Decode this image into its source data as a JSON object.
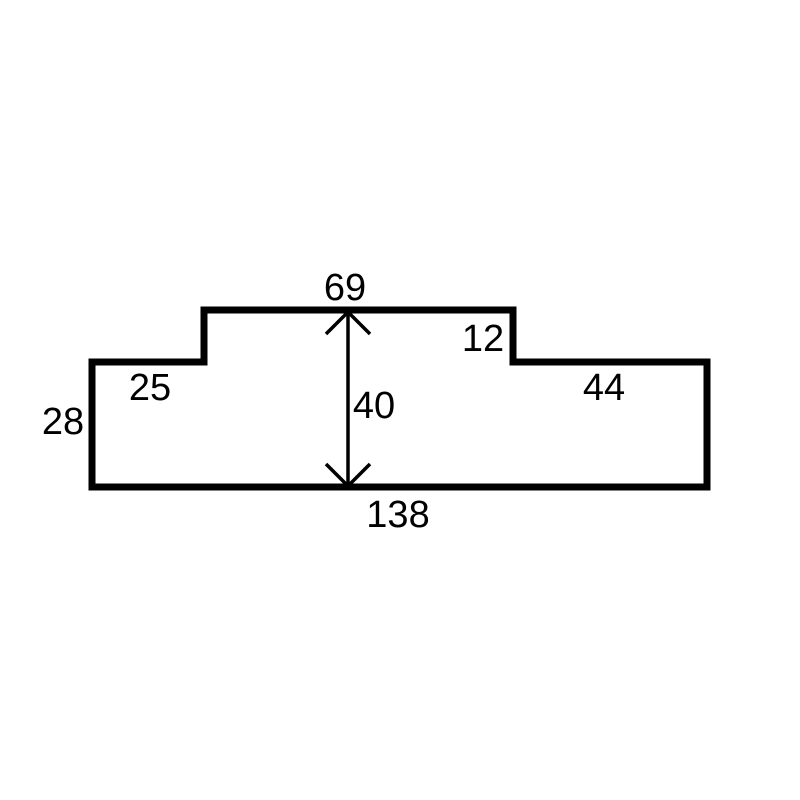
{
  "diagram": {
    "kind": "dimensioned-part-outline",
    "colors": {
      "background": "#ffffff",
      "line": "#000000",
      "text": "#000000"
    },
    "shape": {
      "outline_points": "92,362 204,362 204,310 513,310 513,362 707,362 707,487 92,487",
      "outline_stroke_width": 7
    },
    "dimension_arrow": {
      "x": 348,
      "y_top": 312,
      "y_bottom": 486,
      "stroke_width": 3.5,
      "top_head_points": "326,334 348,312 370,334",
      "bottom_head_points": "326,464 348,486 370,464"
    },
    "dimension_labels": [
      {
        "id": "top-center-width",
        "text": "69",
        "x": 345,
        "y": 300
      },
      {
        "id": "step-depth",
        "text": "12",
        "x": 483,
        "y": 351
      },
      {
        "id": "top-left-width",
        "text": "25",
        "x": 150,
        "y": 400
      },
      {
        "id": "top-right-width",
        "text": "44",
        "x": 604,
        "y": 400
      },
      {
        "id": "left-height",
        "text": "28",
        "x": 63,
        "y": 434
      },
      {
        "id": "center-height",
        "text": "40",
        "x": 374,
        "y": 418
      },
      {
        "id": "bottom-width",
        "text": "138",
        "x": 398,
        "y": 527
      }
    ]
  }
}
